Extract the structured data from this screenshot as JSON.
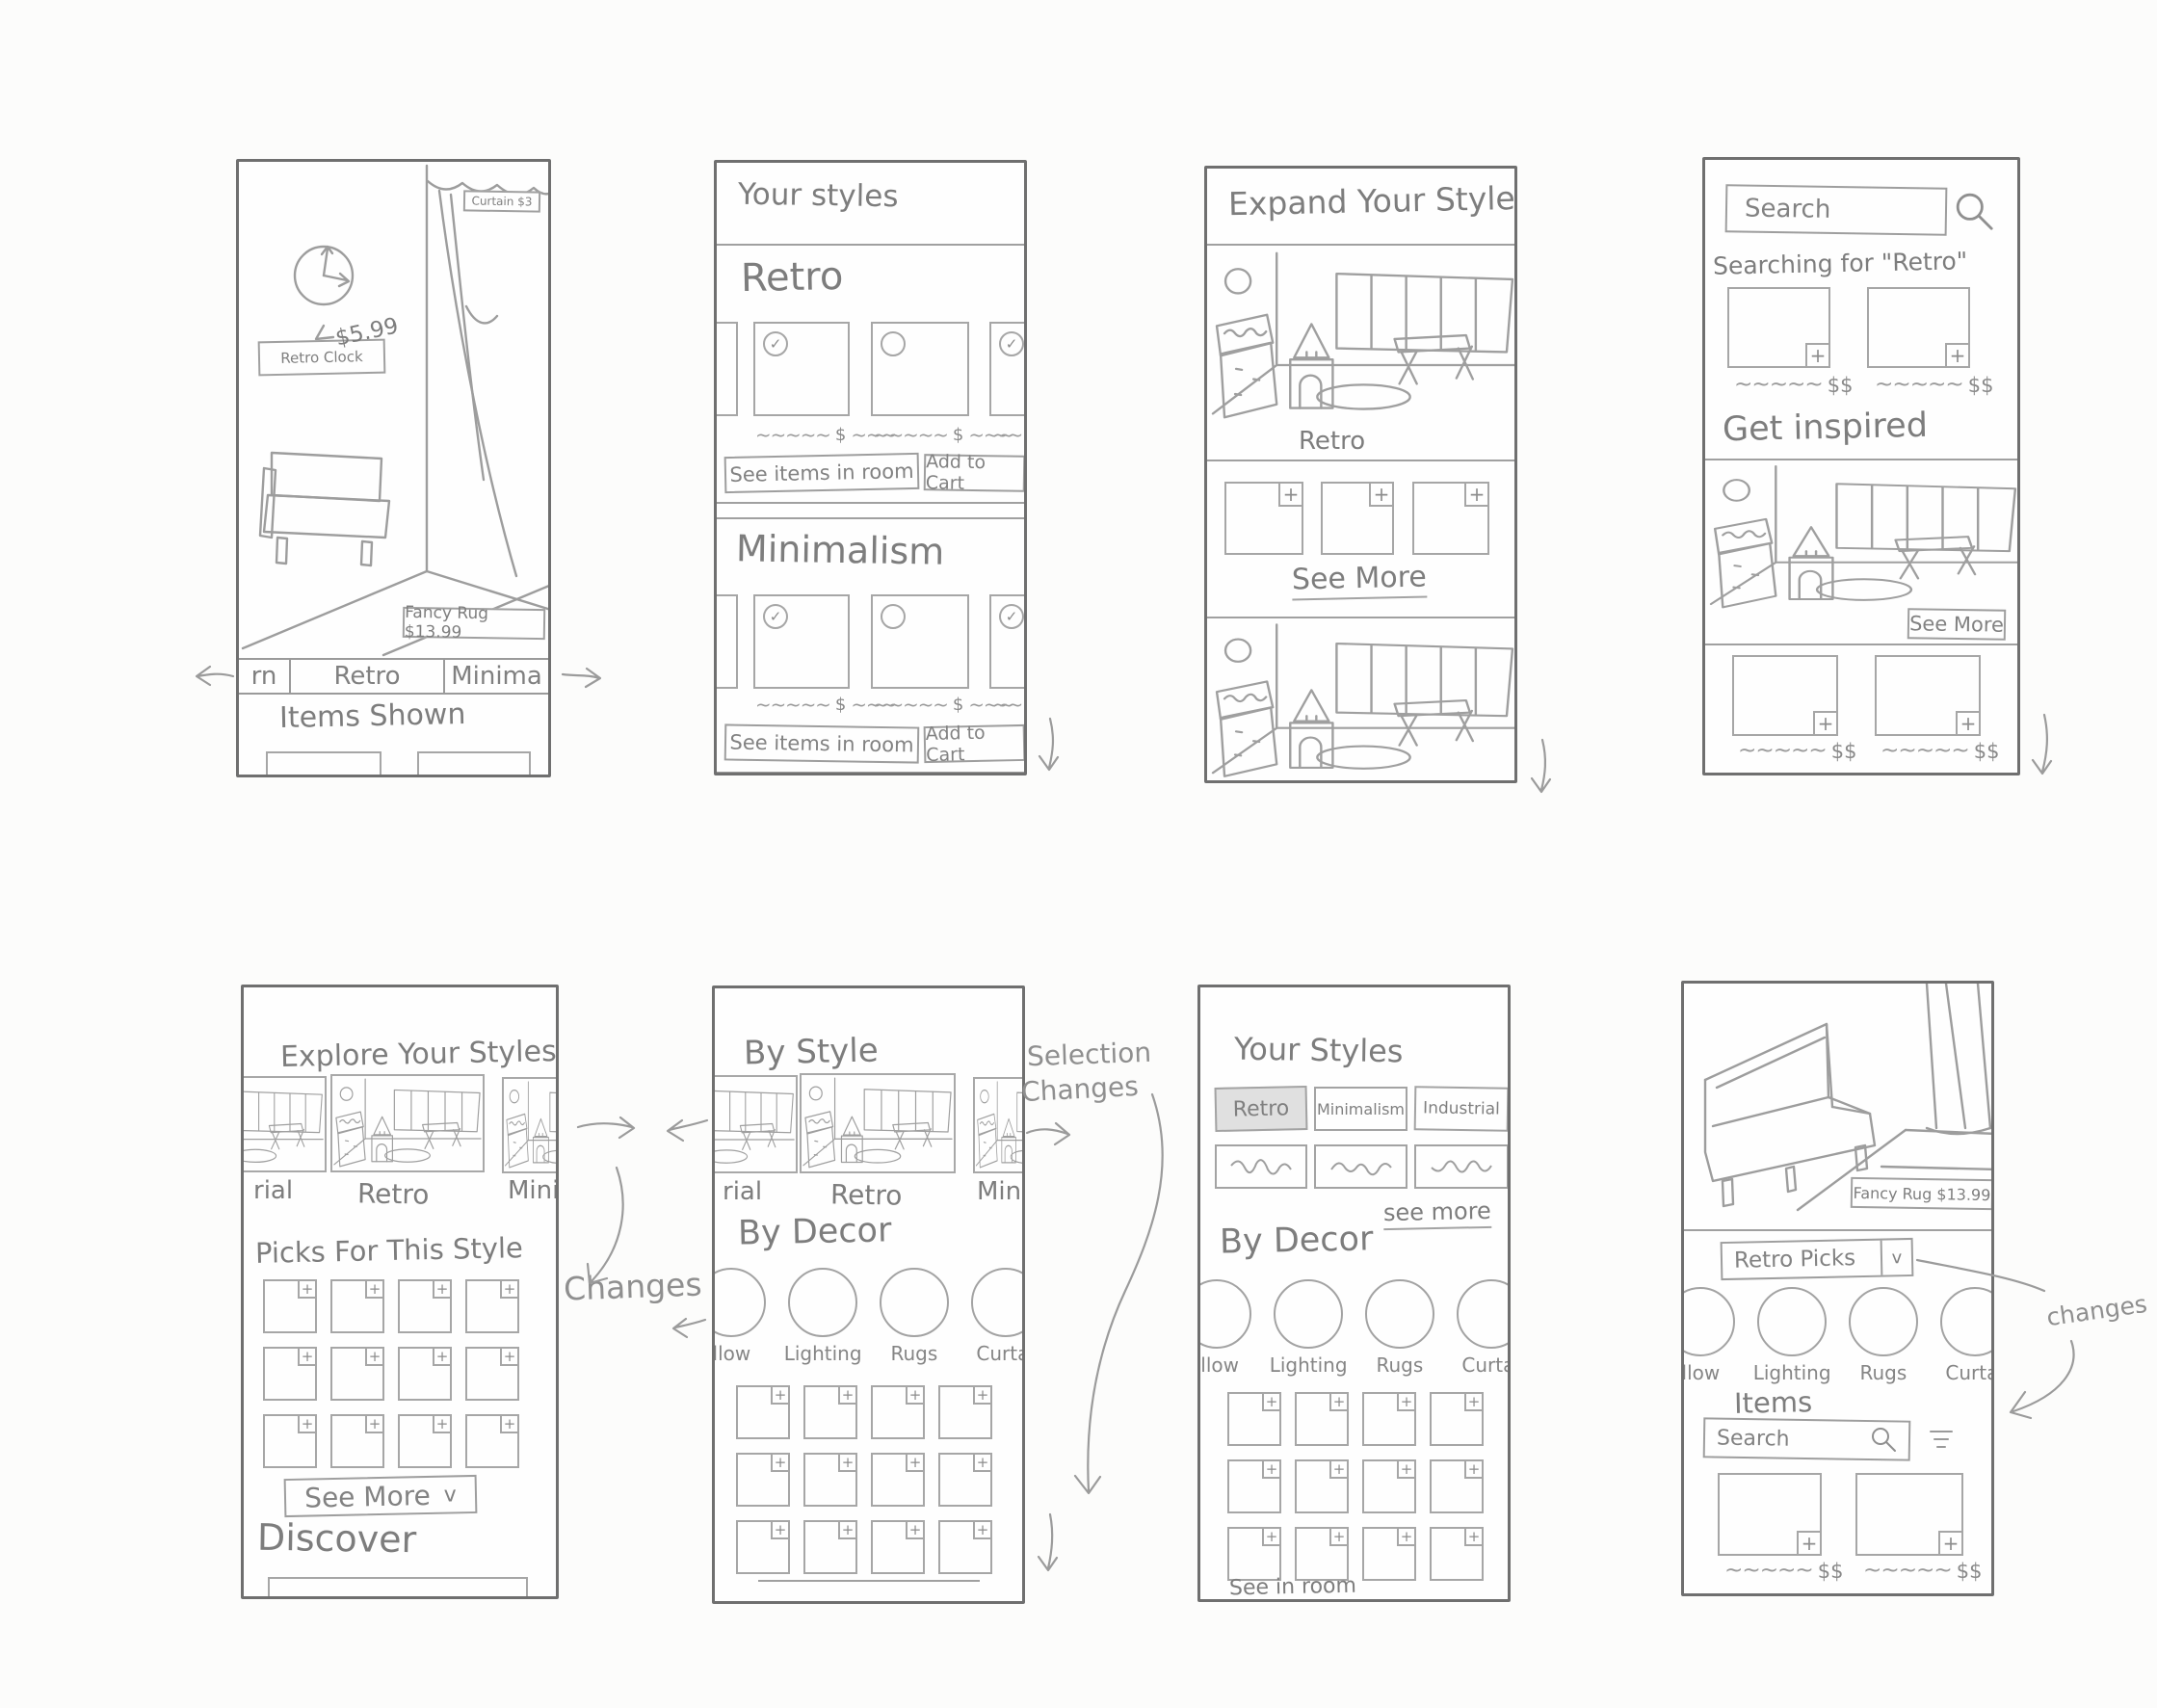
{
  "frame1": {
    "clock_label": "Retro Clock",
    "clock_price": "$5.99",
    "curtain_tag": "Curtain $3",
    "rug_tag": "Fancy Rug $13.99",
    "tabs": [
      "rn",
      "Retro",
      "Minima"
    ],
    "items_shown": "Items Shown"
  },
  "frame2": {
    "title": "Your styles",
    "sections": [
      {
        "name": "Retro"
      },
      {
        "name": "Minimalism"
      }
    ],
    "price": "$",
    "see_items": "See items in room",
    "add_cart": "Add to Cart"
  },
  "frame3": {
    "title": "Expand Your Styles",
    "room_label": "Retro",
    "see_more": "See More"
  },
  "frame4": {
    "search": "Search",
    "searching_for": "Searching for \"Retro\"",
    "price": "$$",
    "inspired": "Get inspired",
    "see_more": "See More"
  },
  "frame5": {
    "title": "Explore Your Styles",
    "carousel": [
      "rial",
      "Retro",
      "Mini"
    ],
    "picks_title": "Picks For This Style",
    "see_more": "See More",
    "chevron": "v",
    "discover": "Discover"
  },
  "frame6": {
    "title": "By Style",
    "carousel": [
      "rial",
      "Retro",
      "Mini"
    ],
    "decor_title": "By Decor",
    "decor": [
      "llow",
      "Lighting",
      "Rugs",
      "Curtai"
    ]
  },
  "frame7": {
    "title": "Your Styles",
    "chips": [
      "Retro",
      "Minimalism",
      "Industrial"
    ],
    "see_more": "see more",
    "decor_title": "By Decor",
    "decor": [
      "illow",
      "Lighting",
      "Rugs",
      "Curtai"
    ],
    "see_in_room": "See in room"
  },
  "frame8": {
    "rug_tag": "Fancy Rug $13.99",
    "picks": "Retro Picks",
    "chevron": "v",
    "decor": [
      "llow",
      "Lighting",
      "Rugs",
      "Curtai"
    ],
    "items": "Items",
    "search": "Search",
    "price": "$$"
  },
  "annotations": {
    "changes": "Changes",
    "selection": [
      "Selection",
      "Changes"
    ],
    "changes_small": "changes"
  }
}
